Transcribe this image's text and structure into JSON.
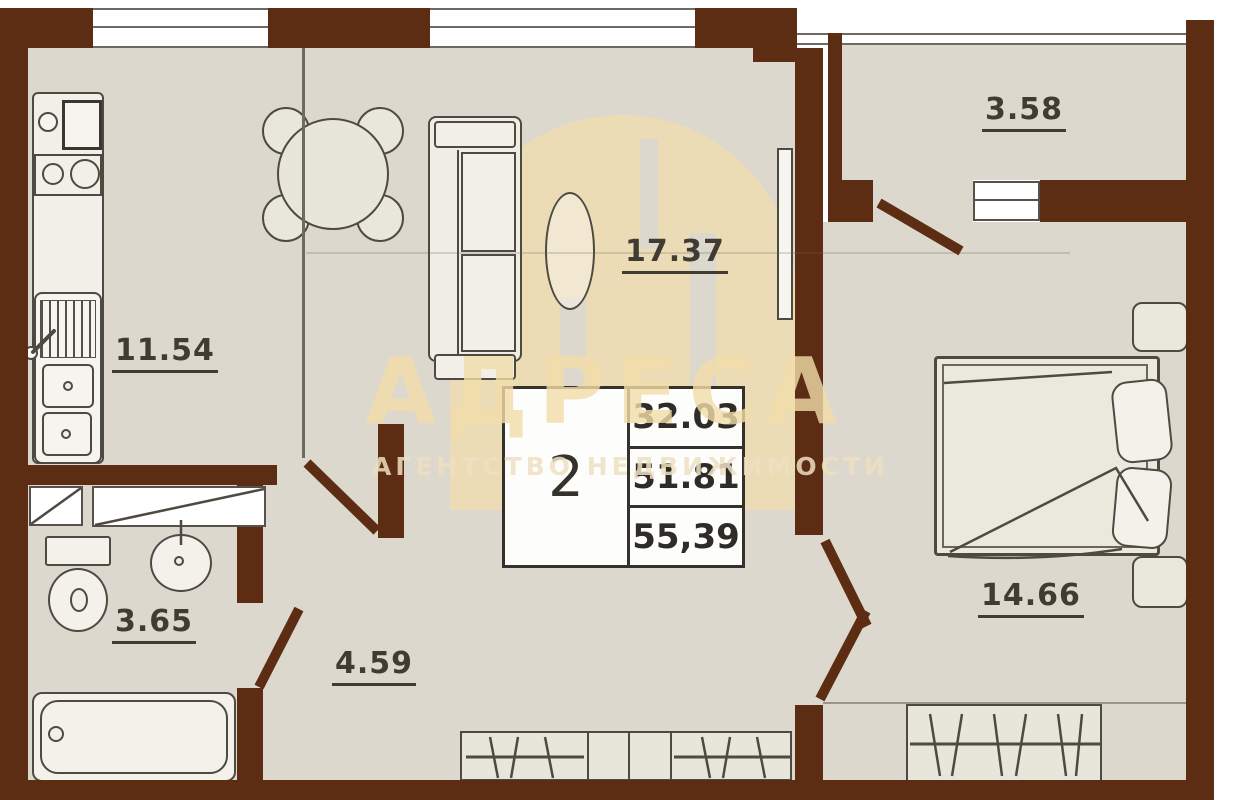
{
  "title": "2-room apartment floor plan",
  "rooms": {
    "kitchen": {
      "name": "kitchen",
      "area": "11.54"
    },
    "living_room": {
      "name": "living-room",
      "area": "17.37"
    },
    "balcony": {
      "name": "balcony",
      "area": "3.58"
    },
    "bedroom": {
      "name": "bedroom",
      "area": "14.66"
    },
    "bathroom": {
      "name": "bathroom",
      "area": "3.65"
    },
    "hallway": {
      "name": "hallway",
      "area": "4.59"
    }
  },
  "summary_table": {
    "rooms_count": "2",
    "living_area": "32.03",
    "apartment_area": "51.81",
    "total_area": "55,39"
  },
  "watermark": {
    "title": "АДРЕСА",
    "subtitle": "АГЕНТСТВО НЕДВИЖИМОСТИ"
  },
  "colors": {
    "wall": "#5c2d13",
    "floor": "#dcd8ce",
    "outline": "#4d4a42",
    "watermark": "#f3dda9"
  }
}
